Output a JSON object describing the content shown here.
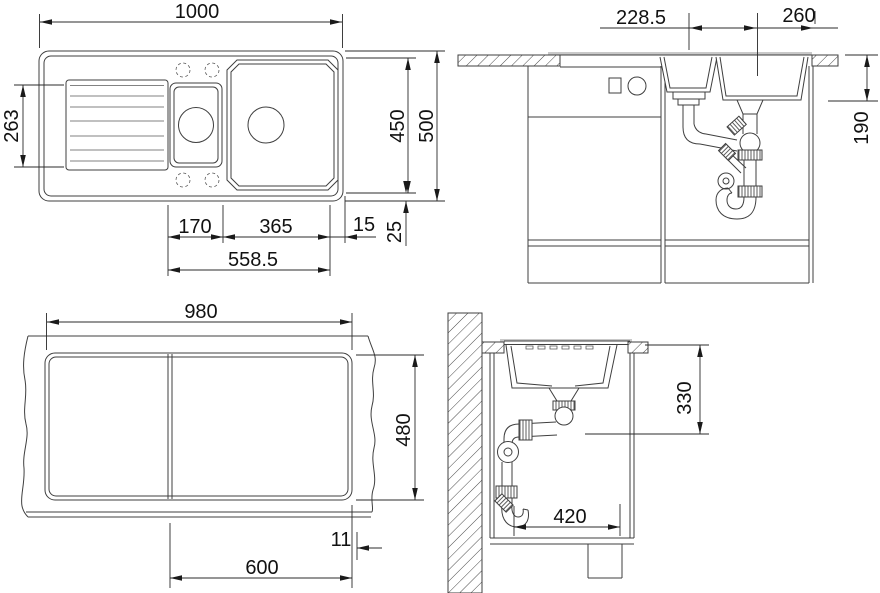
{
  "drawing": {
    "title": "Sink installation technical drawing",
    "views": {
      "top": {
        "label": "top-view",
        "d_width": "1000",
        "d_drainer": "263",
        "d_inner_h": "450",
        "d_outer_h": "500",
        "d_small": "170",
        "d_large": "365",
        "d_edge": "15",
        "d_rim": "25",
        "d_span": "558.5"
      },
      "front": {
        "label": "front-section-view",
        "d_left": "228.5",
        "d_drains": "260",
        "d_depth": "190"
      },
      "cutout": {
        "label": "worktop-cutout-view",
        "d_width": "980",
        "d_height": "480",
        "d_offset": "11",
        "d_cabinet": "600"
      },
      "side": {
        "label": "side-section-view",
        "d_depth": "330",
        "d_clear": "420"
      }
    },
    "colors": {
      "line": "#3f3f3f",
      "text": "#111111",
      "rim_gray": "#c9c9c9"
    }
  }
}
